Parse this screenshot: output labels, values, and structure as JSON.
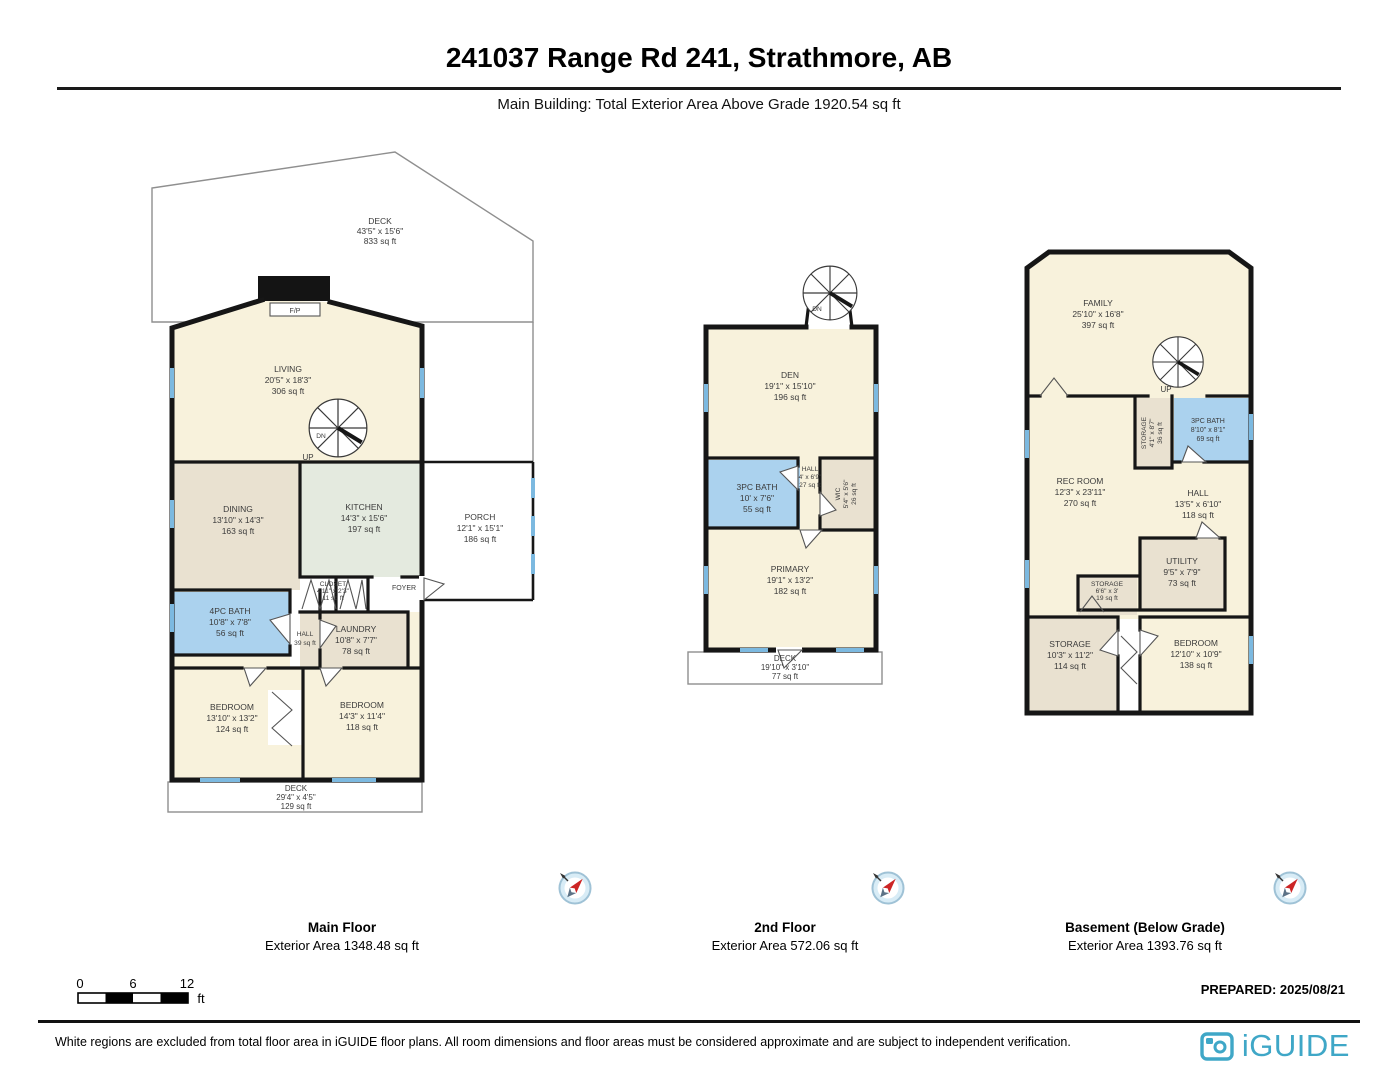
{
  "header": {
    "title": "241037 Range Rd 241, Strathmore, AB",
    "subtitle": "Main Building: Total Exterior Area Above Grade 1920.54 sq ft"
  },
  "floors": {
    "main": {
      "caption": "Main Floor",
      "exterior": "Exterior Area 1348.48 sq ft",
      "rooms": {
        "deck_upper": {
          "name": "DECK",
          "dims": "43'5\" x 15'6\"",
          "area": "833 sq ft"
        },
        "living": {
          "name": "LIVING",
          "dims": "20'5\" x 18'3\"",
          "area": "306 sq ft"
        },
        "dining": {
          "name": "DINING",
          "dims": "13'10\" x 14'3\"",
          "area": "163 sq ft"
        },
        "kitchen": {
          "name": "KITCHEN",
          "dims": "14'3\" x 15'6\"",
          "area": "197 sq ft"
        },
        "porch": {
          "name": "PORCH",
          "dims": "12'1\" x 15'1\"",
          "area": "186 sq ft"
        },
        "closet": {
          "name": "CLOSET",
          "dims": "4'11\" x 2'3\"",
          "area": "11 sq ft"
        },
        "foyer": {
          "name": "FOYER"
        },
        "bath": {
          "name": "4PC BATH",
          "dims": "10'8\" x 7'8\"",
          "area": "56 sq ft"
        },
        "hall": {
          "name": "HALL",
          "area": "39 sq ft"
        },
        "laundry": {
          "name": "LAUNDRY",
          "dims": "10'8\" x 7'7\"",
          "area": "78 sq ft"
        },
        "bedroom_left": {
          "name": "BEDROOM",
          "dims": "13'10\" x 13'2\"",
          "area": "124 sq ft"
        },
        "bedroom_right": {
          "name": "BEDROOM",
          "dims": "14'3\" x 11'4\"",
          "area": "118 sq ft"
        },
        "deck_lower": {
          "name": "DECK",
          "dims": "29'4\" x 4'5\"",
          "area": "129 sq ft"
        },
        "fireplace": {
          "name": "F/P"
        },
        "stair": {
          "dn": "DN",
          "up": "UP"
        }
      }
    },
    "second": {
      "caption": "2nd Floor",
      "exterior": "Exterior Area 572.06 sq ft",
      "rooms": {
        "den": {
          "name": "DEN",
          "dims": "19'1\" x 15'10\"",
          "area": "196 sq ft"
        },
        "bath": {
          "name": "3PC BATH",
          "dims": "10' x 7'6\"",
          "area": "55 sq ft"
        },
        "hall": {
          "name": "HALL",
          "dims": "4' x 6'9\"",
          "area": "27 sq ft"
        },
        "wic": {
          "name": "WIC",
          "dims": "5'4\" x 5'6\"",
          "area": "26 sq ft"
        },
        "primary": {
          "name": "PRIMARY",
          "dims": "19'1\" x 13'2\"",
          "area": "182 sq ft"
        },
        "deck": {
          "name": "DECK",
          "dims": "19'10\" x 3'10\"",
          "area": "77 sq ft"
        },
        "stair": {
          "dn": "DN"
        }
      }
    },
    "basement": {
      "caption": "Basement (Below Grade)",
      "exterior": "Exterior Area 1393.76 sq ft",
      "rooms": {
        "family": {
          "name": "FAMILY",
          "dims": "25'10\" x 16'8\"",
          "area": "397 sq ft"
        },
        "storage_upper": {
          "name": "STORAGE",
          "dims": "4'1\" x 8'7\"",
          "area": "36 sq ft"
        },
        "bath": {
          "name": "3PC BATH",
          "dims": "8'10\" x 8'1\"",
          "area": "69 sq ft"
        },
        "rec_room": {
          "name": "REC ROOM",
          "dims": "12'3\" x 23'11\"",
          "area": "270 sq ft"
        },
        "hall": {
          "name": "HALL",
          "dims": "13'5\" x 6'10\"",
          "area": "118 sq ft"
        },
        "utility": {
          "name": "UTILITY",
          "dims": "9'5\" x 7'9\"",
          "area": "73 sq ft"
        },
        "storage_small": {
          "name": "STORAGE",
          "dims": "6'6\" x 3'",
          "area": "19 sq ft"
        },
        "storage_lower": {
          "name": "STORAGE",
          "dims": "10'3\" x 11'2\"",
          "area": "114 sq ft"
        },
        "bedroom": {
          "name": "BEDROOM",
          "dims": "12'10\" x 10'9\"",
          "area": "138 sq ft"
        },
        "stair": {
          "up": "UP"
        }
      }
    }
  },
  "scale_bar": {
    "tick0": "0",
    "tick1": "6",
    "tick2": "12",
    "unit": "ft"
  },
  "prepared": "PREPARED: 2025/08/21",
  "disclaimer": "White regions are excluded from total floor area in iGUIDE floor plans. All room dimensions and floor areas must be considered approximate and are subject to independent verification.",
  "brand": {
    "name": "iGUIDE",
    "color": "#3fa7c7"
  },
  "palette": {
    "room_cream": "#f8f2dc",
    "room_tan": "#e9e1d0",
    "room_sage": "#e4eadf",
    "room_blue": "#abd2ee",
    "wall": "#161616",
    "window": "#7cb9e0"
  }
}
